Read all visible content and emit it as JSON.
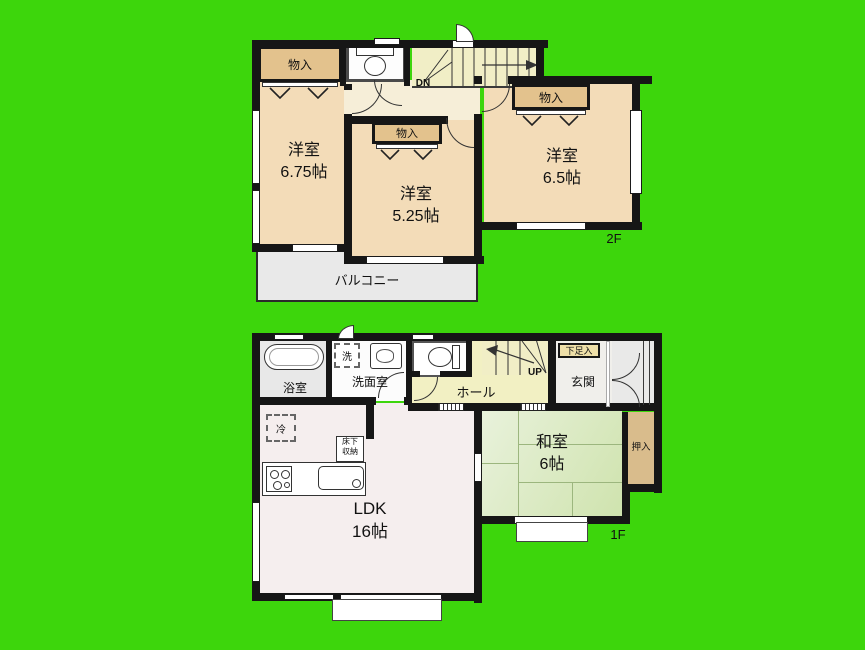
{
  "colors": {
    "background": "#3dd60c",
    "room_peach": "#f3dcb8",
    "corridor_cream": "#f6eed8",
    "stairs_yellow": "#f1eec6",
    "hall_yellow": "#f2f0c3",
    "ldk_pink": "#f5eeee",
    "tatami_green": "#d9eabc",
    "closet_tan": "#e3c28d",
    "oshiire_tan": "#d9bc8c",
    "balcony_gray": "#e9e9e9",
    "wall_black": "#161616"
  },
  "floor2": {
    "floor_label": "2F",
    "room_a": {
      "name": "洋室",
      "area": "6.75帖"
    },
    "room_b": {
      "name": "洋室",
      "area": "5.25帖"
    },
    "room_c": {
      "name": "洋室",
      "area": "6.5帖"
    },
    "closet_a": "物入",
    "closet_b": "物入",
    "closet_c": "物入",
    "balcony_label": "バルコニー",
    "stairs_label": "DN"
  },
  "floor1": {
    "floor_label": "1F",
    "ldk": {
      "name": "LDK",
      "area": "16帖"
    },
    "washitsu": {
      "name": "和室",
      "area": "6帖"
    },
    "bathroom_label": "浴室",
    "laundry_label": "洗",
    "washroom_label": "洗面室",
    "hall_label": "ホール",
    "stairs_label": "UP",
    "shoe_cabinet_label": "下足入",
    "entrance_label": "玄関",
    "oshiire_label": "押入",
    "fridge_label": "冷",
    "floor_storage": {
      "line1": "床下",
      "line2": "収納"
    }
  }
}
